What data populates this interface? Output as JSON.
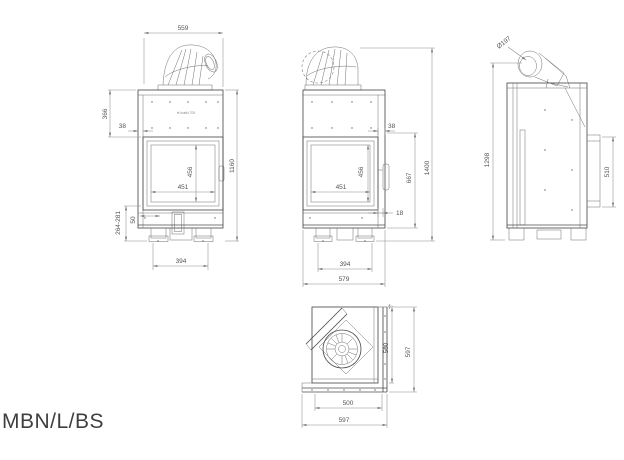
{
  "title": "MBN/L/BS",
  "logo_text": "⊕ kratki 700",
  "views": {
    "front": {
      "dims": {
        "top_width": "559",
        "upper_section_height": "366",
        "door_inset": "38",
        "glass_height": "456",
        "glass_width": "451",
        "total_height": "1160",
        "slot_width": "50",
        "leg_height_range": "264-281",
        "feet_spacing": "394"
      }
    },
    "center": {
      "dims": {
        "side_inset": "38",
        "glass_height": "456",
        "glass_width": "451",
        "door_section_height": "667",
        "total_height": "1400",
        "base_step": "18",
        "feet_spacing": "394",
        "total_width": "579"
      }
    },
    "side": {
      "dims": {
        "flue_diameter": "Ø197",
        "total_height": "1298",
        "rear_panel_height": "510"
      }
    },
    "top": {
      "dims": {
        "body_depth": "500",
        "total_depth": "597",
        "body_width": "500",
        "total_width": "597"
      }
    }
  }
}
